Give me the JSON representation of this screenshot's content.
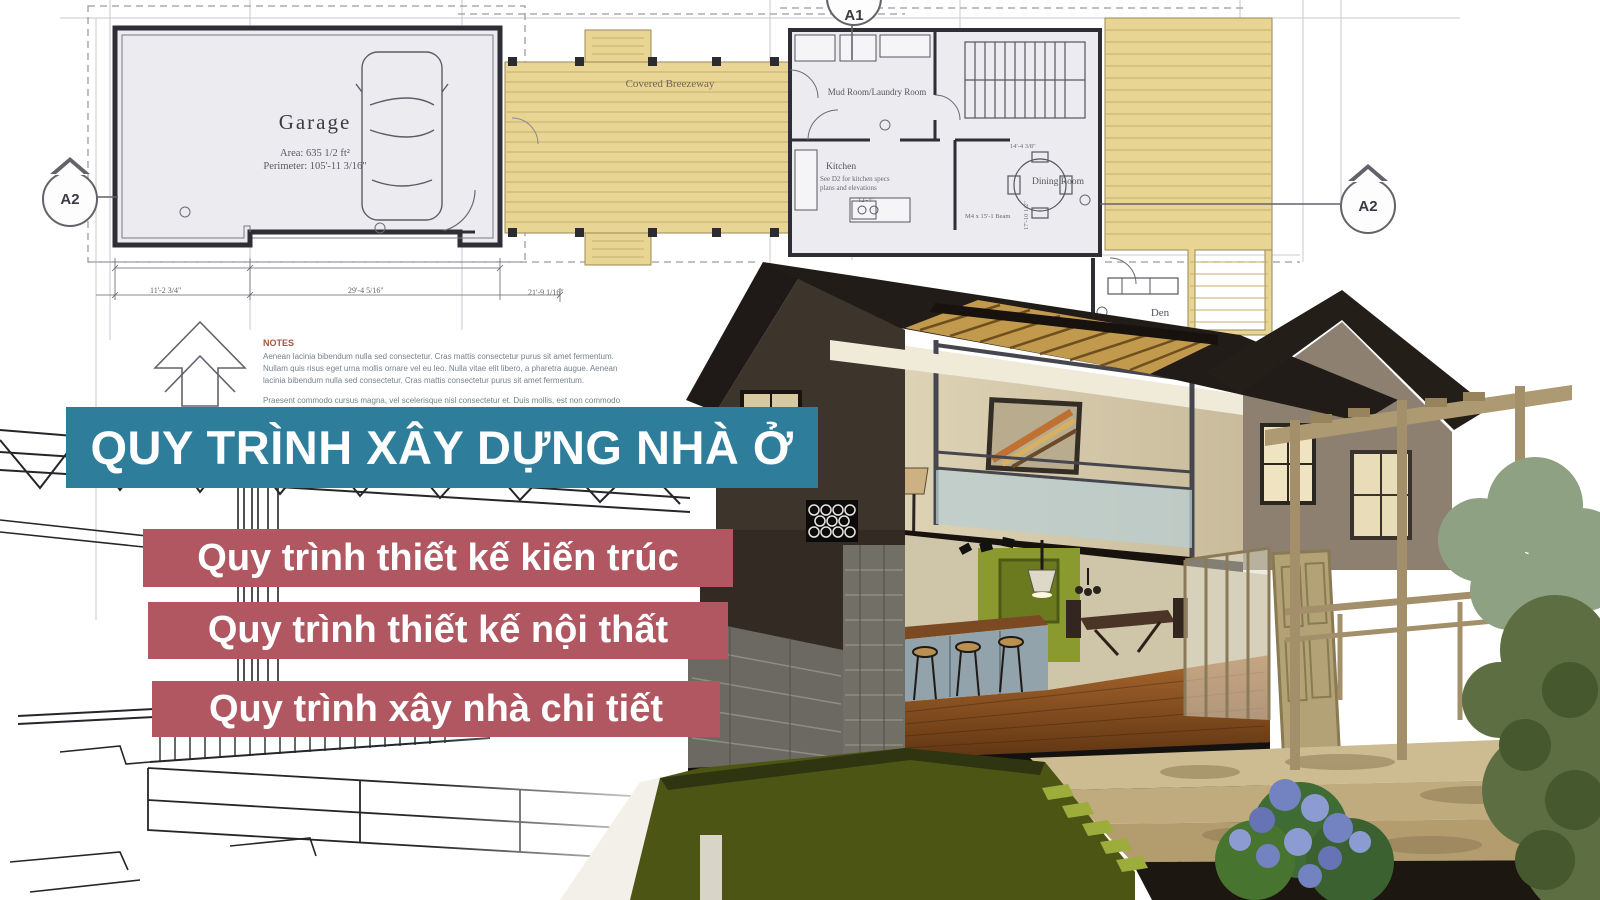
{
  "poster": {
    "title_banner": {
      "label": "QUY TRÌNH XÂY DỰNG NHÀ Ở",
      "bg": "#2e7e9b",
      "text_color": "#ffffff"
    },
    "sub_banners": [
      {
        "label": "Quy trình thiết kế kiến trúc",
        "bg": "#b15762"
      },
      {
        "label": "Quy trình thiết kế nội thất",
        "bg": "#b15762"
      },
      {
        "label": "Quy trình xây nhà chi tiết",
        "bg": "#b15762"
      }
    ]
  },
  "blueprint": {
    "garage": {
      "name": "Garage",
      "area": "Area: 635 1/2 ft²",
      "perimeter": "Perimeter: 105'-11 3/16\""
    },
    "rooms": {
      "mud_room": "Mud Room/Laundry Room",
      "kitchen": "Kitchen",
      "kitchen_note_line1": "See D2 for kitchen specs",
      "kitchen_note_line2": "plans and elevations",
      "dining_room": "Dining Room",
      "den": "Den",
      "breezeway": "Covered Breezeway"
    },
    "section_markers": {
      "top": "A1",
      "left": "A2",
      "right": "A2"
    },
    "dimensions": {
      "garage_seg_left": "11'-2 3/4\"",
      "garage_seg_right": "29'-4 5/16\"",
      "right_run": "21'-9 1/16\"",
      "kitchen_width": "12'-4\"",
      "dining_width": "14'-4 3/8\"",
      "dining_depth": "17'-10 1/2\"",
      "beam_label": "M4 x 15'-1 Beam"
    },
    "notes": {
      "heading": "NOTES",
      "paragraph1": "Aenean lacinia bibendum nulla sed consectetur. Cras mattis consectetur purus sit amet fermentum. Nullam quis risus eget urna mollis ornare vel eu leo. Nulla vitae elit libero, a pharetra augue. Aenean lacinia bibendum nulla sed consectetur. Cras mattis consectetur purus sit amet fermentum.",
      "paragraph2": "Praesent commodo cursus magna, vel scelerisque nisl consectetur et. Duis mollis, est non commodo luctus, nisi erat porttitor ligula, eget lacinia odio sem nec elit. Cum sociis natoque penatibus et magnis dis parturient montes, nascetur."
    }
  },
  "colors": {
    "banner_teal": "#2e7e9b",
    "banner_red": "#b15762",
    "deck_wood": "#e8d493",
    "roof_dark": "#211b16",
    "lawn_green": "#4c5514",
    "accent_wall_green": "#8a9a2e"
  }
}
